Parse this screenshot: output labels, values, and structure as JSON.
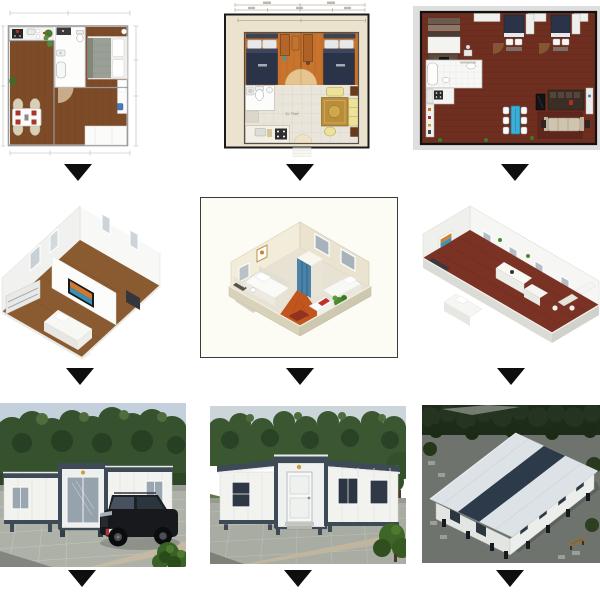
{
  "canvas": {
    "width": 600,
    "height": 600,
    "background": "#ffffff"
  },
  "arrows": {
    "symbol": "down-triangle",
    "color": "#0e0e0e",
    "count": 9
  },
  "grid": {
    "rows": [
      {
        "name": "2d-floor-plans",
        "items": [
          {
            "name": "floor-plan-one-bedroom",
            "type": "2d-floor-plan"
          },
          {
            "name": "floor-plan-two-bedroom",
            "type": "2d-floor-plan",
            "area_label": "11.75㎡"
          },
          {
            "name": "floor-plan-three-bedroom",
            "type": "2d-floor-plan"
          }
        ]
      },
      {
        "name": "3d-renders",
        "items": [
          {
            "name": "render-3d-white-unit",
            "type": "3d-floor-plan"
          },
          {
            "name": "render-3d-two-bedroom",
            "type": "3d-floor-plan"
          },
          {
            "name": "render-3d-long-unit",
            "type": "3d-floor-plan"
          }
        ]
      },
      {
        "name": "product-photos",
        "items": [
          {
            "name": "photo-expandable-house-with-suv",
            "type": "photo"
          },
          {
            "name": "photo-expandable-house-front",
            "type": "photo"
          },
          {
            "name": "photo-house-aerial-dusk",
            "type": "photo"
          }
        ]
      }
    ]
  },
  "colors": {
    "wood": "#7d4b28",
    "woodDark": "#65391c",
    "planCream": "#ebe3cd",
    "planOrange": "#c8742c",
    "bedNavy": "#2a3347",
    "tileFloor": "#e9e5da",
    "rugGold": "#b98d3a",
    "sofaYellow": "#ece29a",
    "brickRed": "#6e2e20",
    "tableBlue": "#3ab0d8",
    "renderWood": "#8a5a30",
    "renderCream": "#f2edda",
    "renderOrange": "#c0561e",
    "renderRed": "#7a3224",
    "wardrobeBlue": "#4a82a8",
    "sky": "#bcc9d4",
    "sky2": "#ccd5da",
    "tree": "#35512d",
    "treeDark": "#273f22",
    "houseWhite": "#f2f2ef",
    "frameNavy": "#3e4a56",
    "paver": "#aeb1a8",
    "paver2": "#a9aca3",
    "suvBlack": "#17191c",
    "bushGreen": "#3a6226",
    "duskGround": "#6e746d",
    "duskTree": "#1f2b1a",
    "roofWhite": "#dce2e6",
    "roofNavy": "#2c3a4a",
    "mat": "#dedede"
  }
}
